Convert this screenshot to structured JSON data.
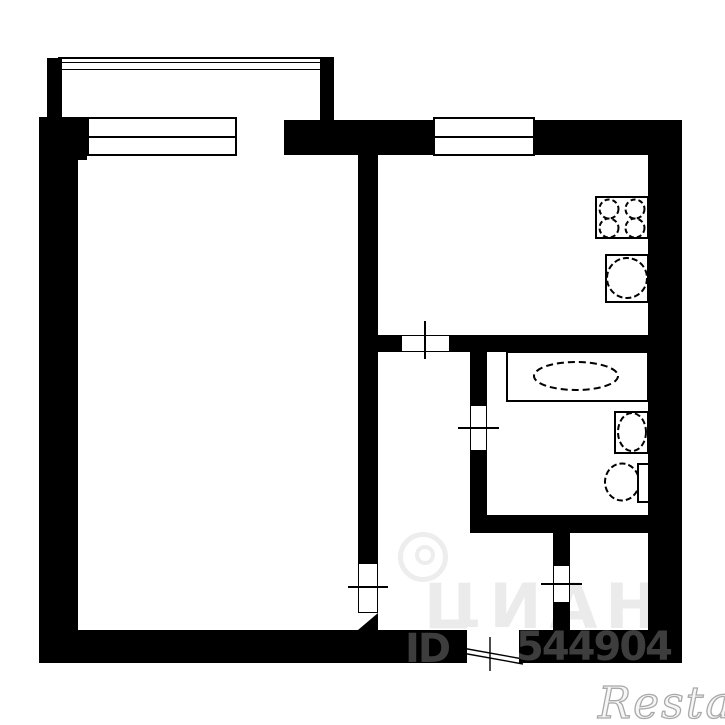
{
  "plan": {
    "type": "apartment-floor-plan",
    "rooms": [
      "living-room",
      "kitchen",
      "bathroom",
      "hallway",
      "closet",
      "balcony"
    ],
    "fixtures": [
      "balcony-railing",
      "living-room-window",
      "balcony-door",
      "kitchen-window",
      "stove",
      "kitchen-sink",
      "bathtub",
      "washbasin",
      "toilet",
      "living-room-door",
      "kitchen-door",
      "bathroom-door",
      "closet-door",
      "entrance-door"
    ]
  },
  "colors": {
    "wall": "#000000",
    "background": "#ffffff",
    "id_watermark": "#3d3d3d",
    "site_watermark": "#ebebeb",
    "brand_watermark_stroke": "#a9a9a9"
  },
  "watermarks": {
    "site": "ЦИАН",
    "id_label": "ID",
    "id_number": "544904",
    "brand": "Restate"
  }
}
